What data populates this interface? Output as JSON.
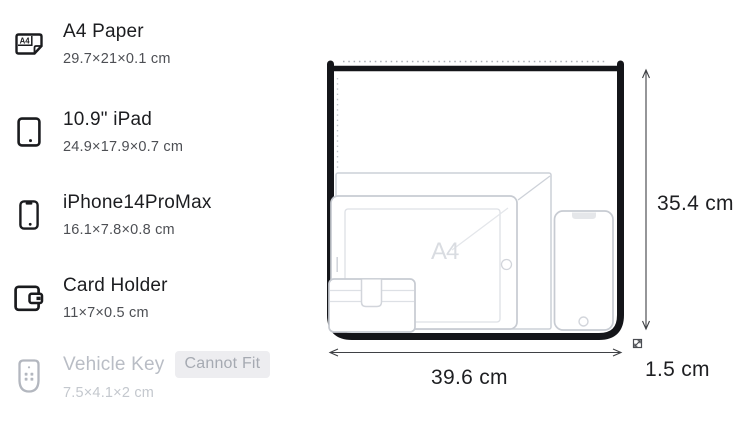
{
  "items": [
    {
      "name": "A4 Paper",
      "dims": "29.7×21×0.1 cm"
    },
    {
      "name": "10.9\" iPad",
      "dims": "24.9×17.9×0.7 cm"
    },
    {
      "name": "iPhone14ProMax",
      "dims": "16.1×7.8×0.8 cm"
    },
    {
      "name": "Card Holder",
      "dims": "11×7×0.5 cm"
    },
    {
      "name": "Vehicle Key",
      "dims": "7.5×4.1×2 cm",
      "badge": "Cannot Fit",
      "fits": false
    }
  ],
  "diagram": {
    "watermark": "A4",
    "height_label": "35.4 cm",
    "width_label": "39.6 cm",
    "depth_label": "1.5 cm"
  },
  "colors": {
    "bag_outline": "#141519",
    "item_outline": "#c7cbd2",
    "disabled_gray": "#b9bdc5",
    "badge_bg": "#ededf0",
    "dimension_line": "#3f4145"
  }
}
